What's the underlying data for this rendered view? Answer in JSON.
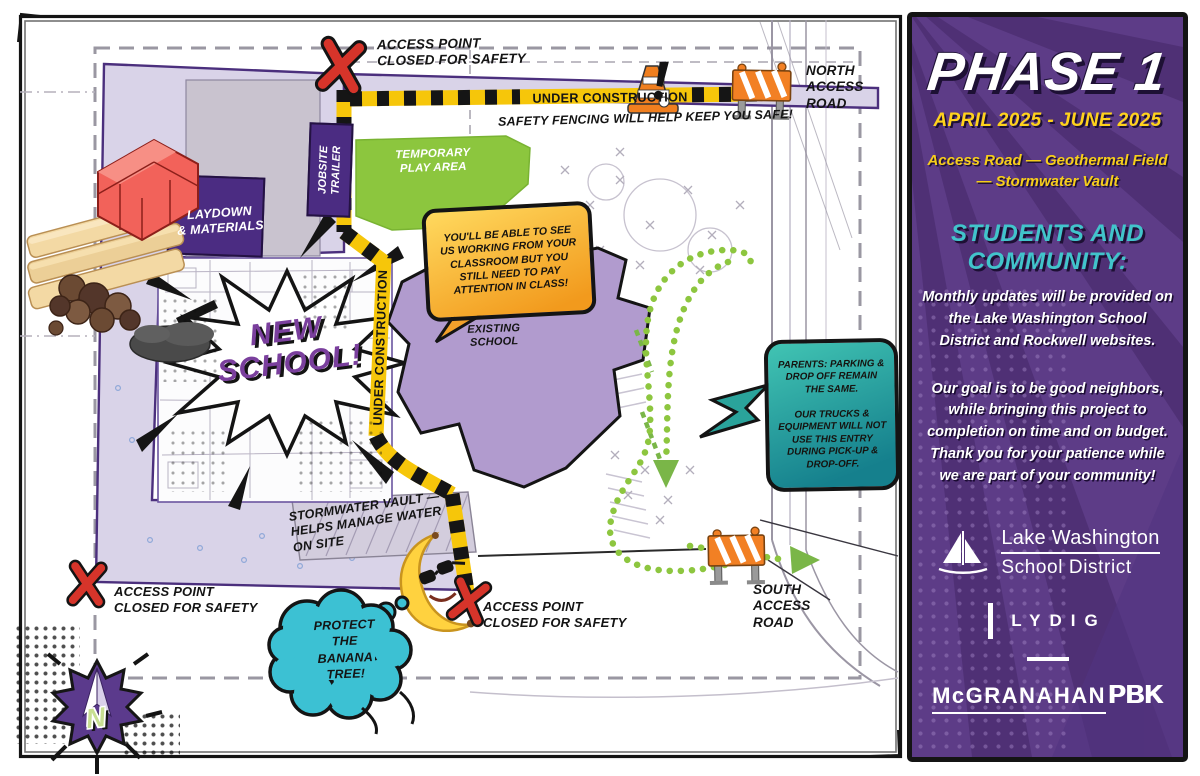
{
  "map": {
    "labels": {
      "access_top": "ACCESS POINT\nCLOSED FOR SAFETY",
      "access_left": "ACCESS POINT\nCLOSED FOR SAFETY",
      "access_south": "ACCESS POINT\nCLOSED FOR SAFETY",
      "under_construction_top": "UNDER CONSTRUCTION",
      "under_construction_side": "UNDER CONSTRUCTION",
      "safety_fencing": "SAFETY FENCING WILL HELP KEEP YOU SAFE!",
      "north_access_road": "NORTH\nACCESS\nROAD",
      "south_access_road": "SOUTH\nACCESS\nROAD",
      "temporary_play_area": "TEMPORARY\nPLAY AREA",
      "jobsite_trailer": "JOBSITE\nTRAILER",
      "laydown_materials": "LAYDOWN\n& MATERIALS",
      "new_school": "NEW\nSCHOOL!",
      "existing_school": "EXISTING\nSCHOOL",
      "stormwater_vault": "STORMWATER VAULT —\nHELPS MANAGE WATER\nON SITE",
      "compass_n": "N"
    },
    "bubbles": {
      "classroom": "YOU'LL BE ABLE TO SEE\nUS WORKING FROM YOUR\nCLASSROOM BUT YOU\nSTILL NEED TO PAY\nATTENTION IN CLASS!",
      "parents": "PARENTS: PARKING &\nDROP OFF REMAIN\nTHE SAME.\n\nOUR TRUCKS &\nEQUIPMENT WILL NOT\nUSE THIS ENTRY\nDURING PICK-UP &\nDROP-OFF.",
      "banana": "PROTECT\nTHE\nBANANA\nTREE!"
    }
  },
  "panel": {
    "title": "PHASE 1",
    "dates": "APRIL 2025 - JUNE 2025",
    "scope": "Access Road — Geothermal Field\n— Stormwater Vault",
    "heading": "STUDENTS AND\nCOMMUNITY:",
    "para1": "Monthly updates will be provided on\nthe Lake Washington School\nDistrict and Rockwell websites.",
    "para2": "Our goal is to be good neighbors,\nwhile bringing this project to\ncompletion on time and on budget.\nThank you for your patience while\nwe are part of your community!",
    "logos": {
      "district_line1": "Lake Washington",
      "district_line2": "School District",
      "contractor": "LYDIG",
      "architect": "McGRANAHAN",
      "architect_suffix": "PBK"
    }
  },
  "colors": {
    "panel_purple": "#5d3c87",
    "panel_ray": "#4d2f72",
    "accent_yellow": "#ffd21c",
    "accent_teal": "#41c4cb",
    "hazard_yellow": "#f6c60a",
    "closed_red": "#d6342a",
    "play_green": "#8cc63e",
    "route_green": "#8dc63f",
    "school_purple": "#b19bce",
    "zone_lavender": "#d9d3e8",
    "box_purple": "#4b2c82",
    "cone_orange": "#f28024",
    "bubble_orange": "#f7a11f",
    "bubble_teal": "#2aa3a0",
    "cloud_teal": "#3cc1d3"
  }
}
